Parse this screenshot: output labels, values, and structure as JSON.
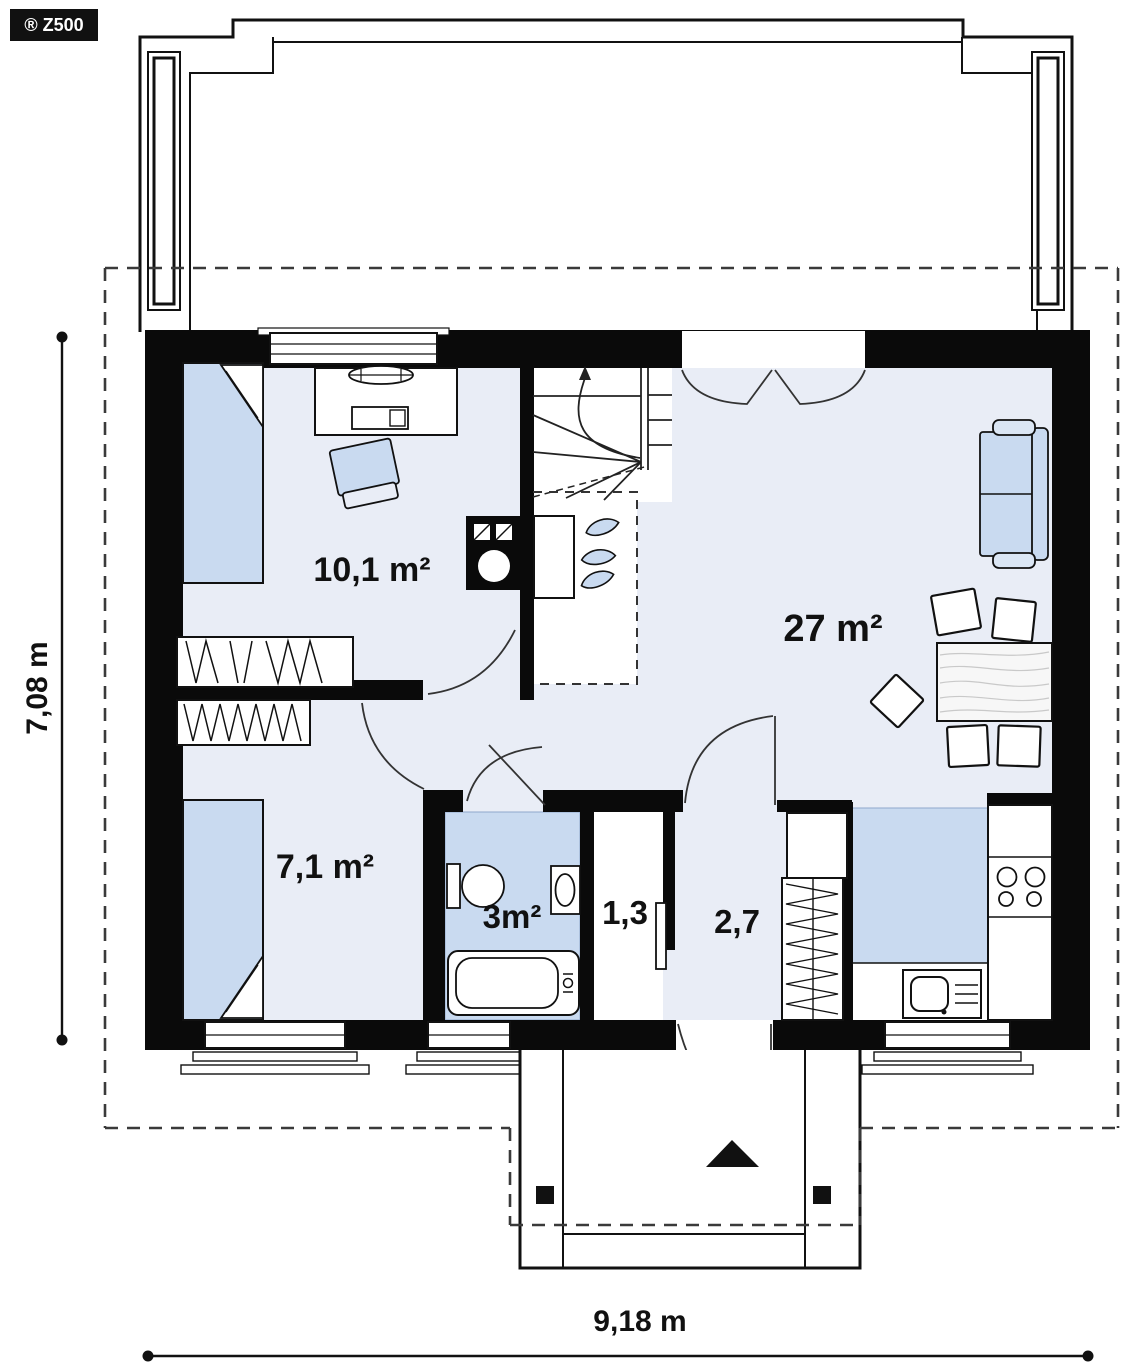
{
  "badge": {
    "label": "® Z500"
  },
  "rooms": {
    "bedroom_large": {
      "area_label": "10,1 m²"
    },
    "living_room": {
      "area_label": "27 m²"
    },
    "bedroom_small": {
      "area_label": "7,1 m²"
    },
    "bathroom": {
      "area_label": "3m²"
    },
    "closet": {
      "area_label": "1,3"
    },
    "hall": {
      "area_label": "2,7"
    }
  },
  "dimensions": {
    "overall_depth": "7,08 m",
    "overall_width": "9,18 m"
  },
  "colors": {
    "wall": "#0a0a0a",
    "floor": "#e9edf6",
    "furniture_blue": "#c9daf0",
    "wet_zone_blue": "#c9daf0",
    "badge_bg": "#111111"
  },
  "furniture_symbols": [
    "bed",
    "desk",
    "desk-chair",
    "armchair",
    "wardrobe",
    "stove-fireplace",
    "winder-staircase",
    "plants",
    "sofa",
    "lounge-chairs",
    "dining-table",
    "dining-chairs",
    "toilet",
    "washbasin",
    "bathtub",
    "hall-wardrobe",
    "cabinet",
    "kitchen-counter",
    "cooktop",
    "kitchen-sink",
    "entrance-arrow"
  ]
}
